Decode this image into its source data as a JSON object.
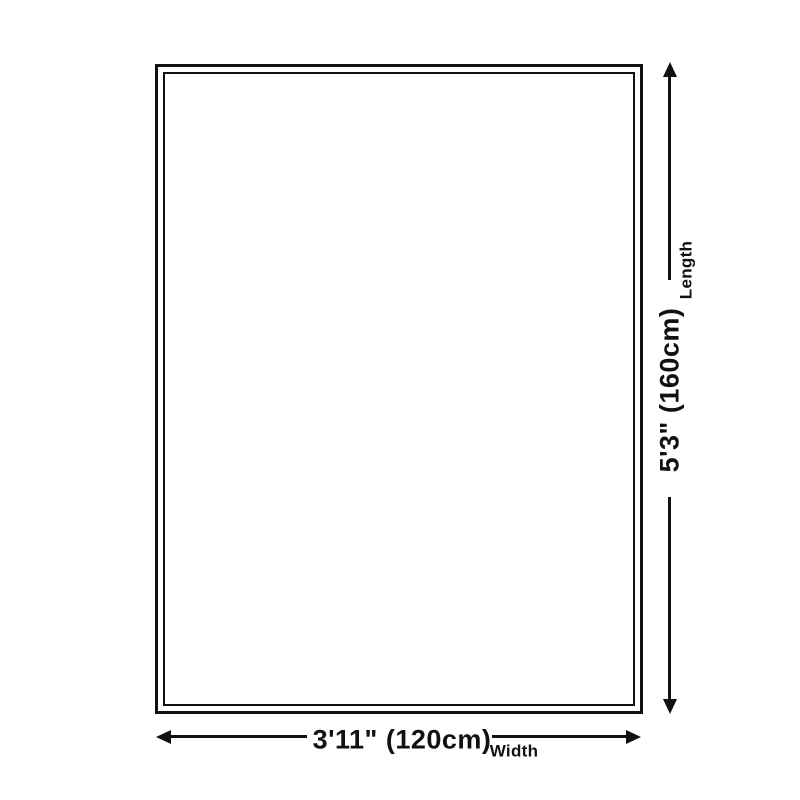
{
  "page": {
    "background_color": "#ffffff",
    "line_color": "#111111"
  },
  "diagram": {
    "type": "product-size-diagram",
    "shape": "rectangle-with-double-border",
    "width_dimension": {
      "value": "3'11\" (120cm)",
      "label": "Width"
    },
    "length_dimension": {
      "value": "5'3\" (160cm)",
      "label": "Length"
    },
    "icons": {
      "up_arrow": "▲",
      "down_arrow": "▼",
      "left_arrow": "◀",
      "right_arrow": "▶"
    }
  }
}
